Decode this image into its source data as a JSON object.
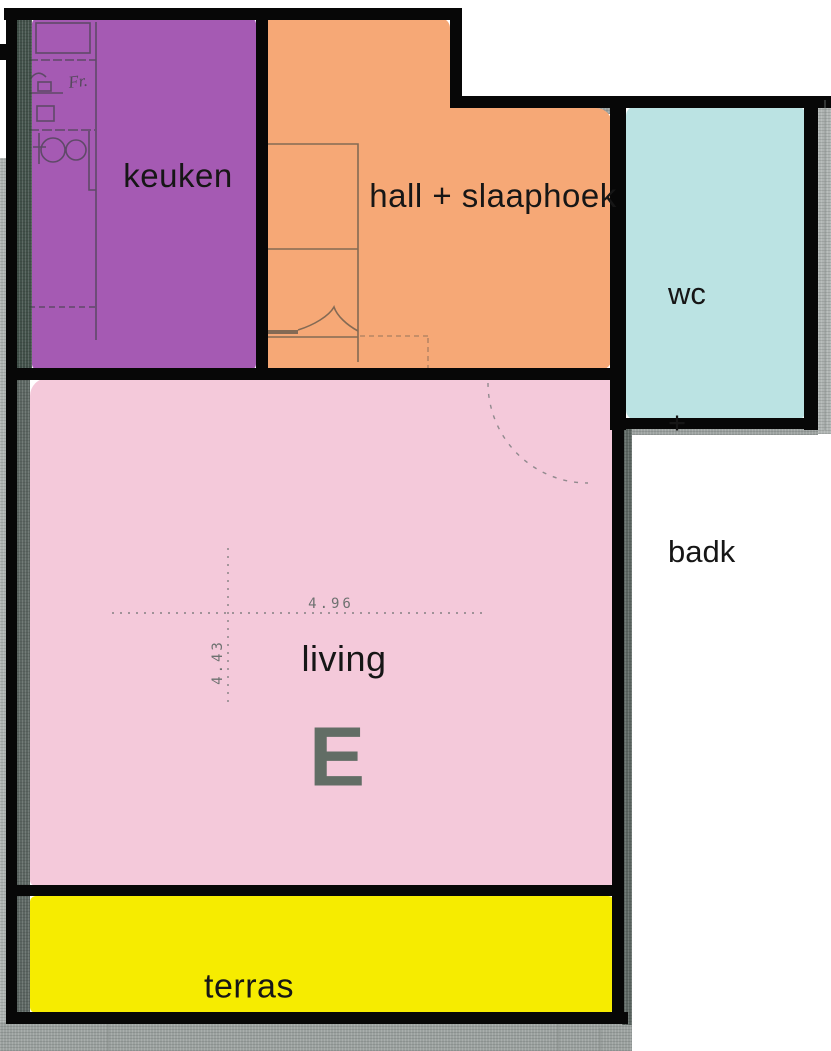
{
  "plan_title": "apartment floor plan",
  "colors": {
    "keuken": "#a55ab3",
    "hall": "#f6a876",
    "wc_badk": "#bbe3e3",
    "living": "#f4c9da",
    "terras": "#f6ec00",
    "wall": "#070707",
    "wall_texture_light": "#afb4b2",
    "wall_texture_dark": "#9ba19f",
    "kitchen_strip": "#42514a",
    "side_strip": "#5c6662",
    "stamp": "#4e6156",
    "pencil": "#5f6865"
  },
  "rooms": {
    "keuken": {
      "label": "keuken"
    },
    "hall": {
      "label": "hall + slaaphoek"
    },
    "wc_badk": {
      "line1": "wc",
      "line2": "+",
      "line3": "badk"
    },
    "living": {
      "label": "living",
      "unit_letter": "E",
      "width_m": "4.96",
      "depth_m": "4.43"
    },
    "terras": {
      "label": "terras"
    }
  },
  "annotations": {
    "fridge_note": "Fr."
  }
}
